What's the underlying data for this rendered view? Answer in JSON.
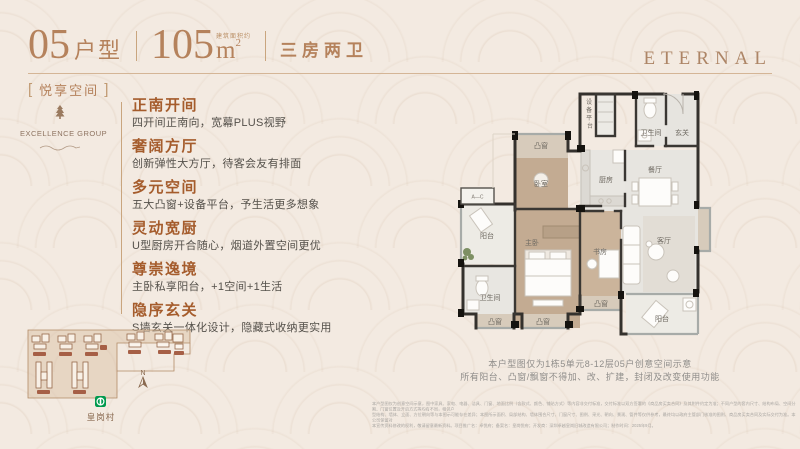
{
  "header": {
    "unit_number": "05",
    "unit_suffix": "户型",
    "area_value": "105",
    "area_note": "建筑面积约",
    "area_unit": "m",
    "area_sup": "2",
    "layout_label": "三房两卫",
    "brand_logo": "ETERNAL"
  },
  "tag": {
    "open": "[",
    "label": "悦享空间",
    "close": "]"
  },
  "brand": {
    "name": "EXCELLENCE GROUP"
  },
  "features": [
    {
      "title": "正南开间",
      "desc": "四开间正南向，宽幕PLUS视野"
    },
    {
      "title": "奢阔方厅",
      "desc": "创新弹性大方厅，待客会友有排面"
    },
    {
      "title": "多元空间",
      "desc": "五大凸窗+设备平台，予生活更多想象"
    },
    {
      "title": "灵动宽厨",
      "desc": "U型厨房开合随心，烟道外置空间更优"
    },
    {
      "title": "尊崇逸境",
      "desc": "主卧私享阳台，+1空间+1生活"
    },
    {
      "title": "隐序玄关",
      "desc": "S墙玄关一体化设计，隐藏式收纳更实用"
    }
  ],
  "site_map": {
    "north_label": "N",
    "station_label": "皇岗村"
  },
  "floor_plan": {
    "rooms": {
      "bay": "凸窗",
      "bedroom2": "卧室",
      "master": "主卧",
      "study": "书房",
      "living": "客厅",
      "dining": "餐厅",
      "kitchen": "厨房",
      "bath": "卫生间",
      "foyer": "玄关",
      "balcony": "阳台",
      "equipment": "设备平台",
      "ac": "A—C"
    }
  },
  "caption": {
    "line1": "本户型图仅为1栋5单元8-12层05户创意空间示意",
    "line2": "所有阳台、凸窗/飘窗不得加、改、扩建，封闭及改变使用功能"
  },
  "disclaimer": {
    "line1": "本户型图仅为创意空间示意，图中家具、家电、电器、洁具、门窗、地面比例（含款式、颜色、铺贴方式）等内容非交付标准，交付标准以双方签署的《商品房买卖合同》及其附件约定为准；不同户型的套内尺寸、结构布局、空间分割、门窗位置及开启方式等均有不同，相邻户",
    "line2": "型结构、墙体、立面、方位朝向等与本图示可能存在差异；本图所示面积、局部结构、墙体围合尺寸、门窗尺寸、图例、采光、朝向、景观、管井等仅供参考，最终均以政府主管部门核准的图则、商品房买卖合同及实际交付为准。本公司保留对",
    "line3": "本宣传资料修改的权利，敬请留意最新资料。项目推广名：卓悦府；备案名：皇岗悦府；开发商：深圳卓越皇岗旧城改造有限公司；制作时间：2025年9月。"
  },
  "colors": {
    "background_cream": "#f3eae1",
    "accent_bronze": "#b5825c",
    "heading_brown": "#a55c2c",
    "wall_dark": "#34312d",
    "bedroom_tan": "#c3ab92",
    "metro_green": "#009a4e"
  }
}
